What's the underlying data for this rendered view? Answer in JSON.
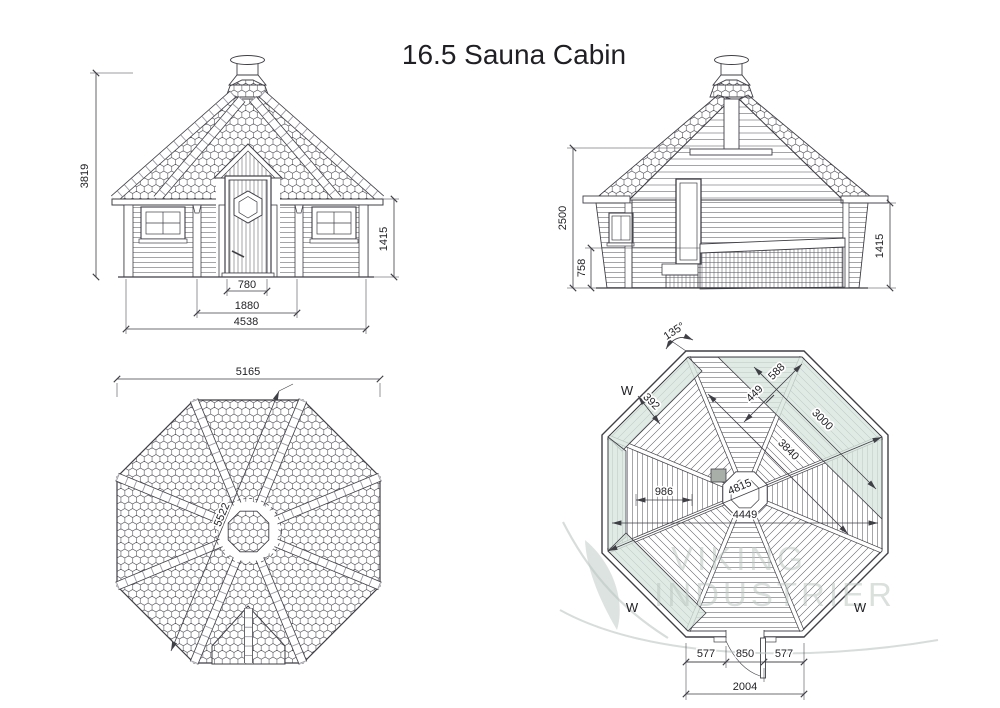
{
  "title": "16.5 Sauna Cabin",
  "watermark": {
    "line1": "VIKING",
    "line2": "INDUSTRIER"
  },
  "views": {
    "front_elevation": {
      "dims": {
        "total_height": "3819",
        "wall_height": "1415",
        "door_width": "780",
        "door_bay": "1880",
        "facade_width": "4538"
      }
    },
    "section": {
      "dims": {
        "ridge_height": "2500",
        "bench_height": "758",
        "wall_height": "1415"
      }
    },
    "roof_plan": {
      "dims": {
        "width": "5165",
        "diagonal": "5522"
      }
    },
    "floor_plan": {
      "angle_label": "135°",
      "window_marks": {
        "upper_left": "W",
        "lower_left": "W",
        "lower_right": "W"
      },
      "dims": {
        "bench_width_small": "392",
        "seat_inner": "449",
        "seat_outer": "588",
        "bench_length": "3000",
        "clear_diagonal": "3840",
        "left_bench_span": "986",
        "interior_diagonal": "4815",
        "interior_width": "4449",
        "door_left": "577",
        "door_width": "850",
        "door_right": "577",
        "entrance_wall": "2004"
      }
    }
  },
  "colors": {
    "line": "#3f3f46",
    "bench_fill": "#d9e6df",
    "watermark": "#bcc7c1",
    "text": "#1f1f24",
    "background": "#ffffff"
  }
}
